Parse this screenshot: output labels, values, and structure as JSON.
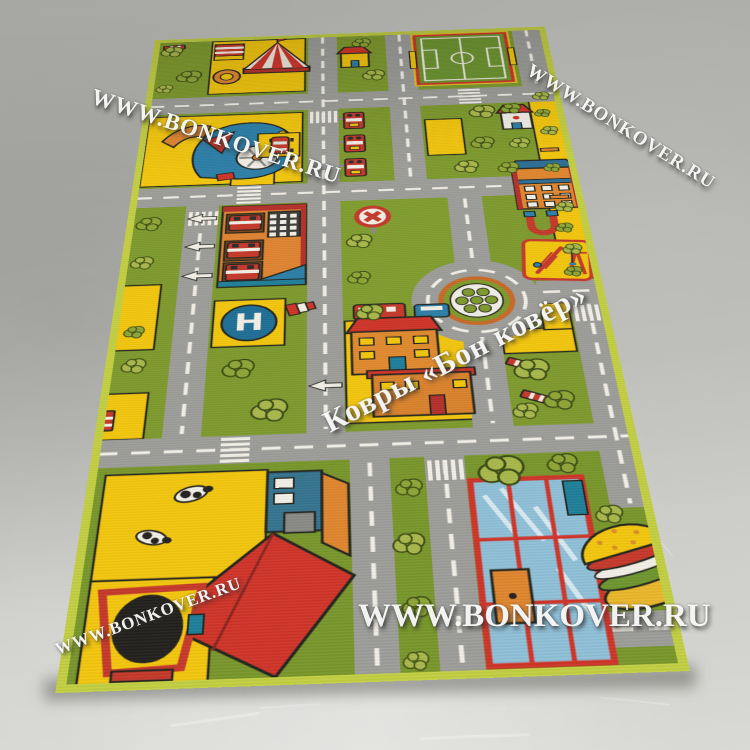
{
  "watermarks": {
    "site_url": "WWW.BONKOVER.RU",
    "brand_name": "Ковры «Бон ковёр»",
    "instances": [
      {
        "position": "top-left",
        "text": "WWW.BONKOVER.RU"
      },
      {
        "position": "top-right",
        "text": "WWW.BONKOVER.RU"
      },
      {
        "position": "center-diagonal",
        "text": "Ковры «Бон ковёр»"
      },
      {
        "position": "bottom-center",
        "text": "WWW.BONKOVER.RU"
      },
      {
        "position": "bottom-left",
        "text": "WWW.BONKOVER.RU"
      }
    ]
  },
  "rug": {
    "helipad_letter": "H",
    "colors": {
      "grass_green": "#7e9a2d",
      "road_gray": "#9d9d99",
      "block_yellow": "#f3c60d",
      "accent_red": "#c5392b",
      "roof_red": "#cf3428",
      "accent_orange": "#e0862f",
      "accent_blue": "#2d7fa8",
      "accent_teal": "#1f7f99",
      "marking_white": "#f2efe6",
      "binding_edge": "#c2cf42"
    },
    "elements": [
      "circus-tent",
      "football-field",
      "fire-station",
      "helipad",
      "roundabout",
      "traffic-lights",
      "no-entry-sign",
      "town-houses",
      "farm-barn",
      "cows",
      "tractor",
      "playground",
      "school-building",
      "mall-building",
      "hamburger-kiosk",
      "toy-train",
      "windsock",
      "parked-car",
      "trees",
      "benches",
      "zebra-crossings",
      "direction-arrows",
      "magnet-toy",
      "cottage"
    ]
  },
  "floor": {
    "surface_gray": "#b3b3af"
  }
}
